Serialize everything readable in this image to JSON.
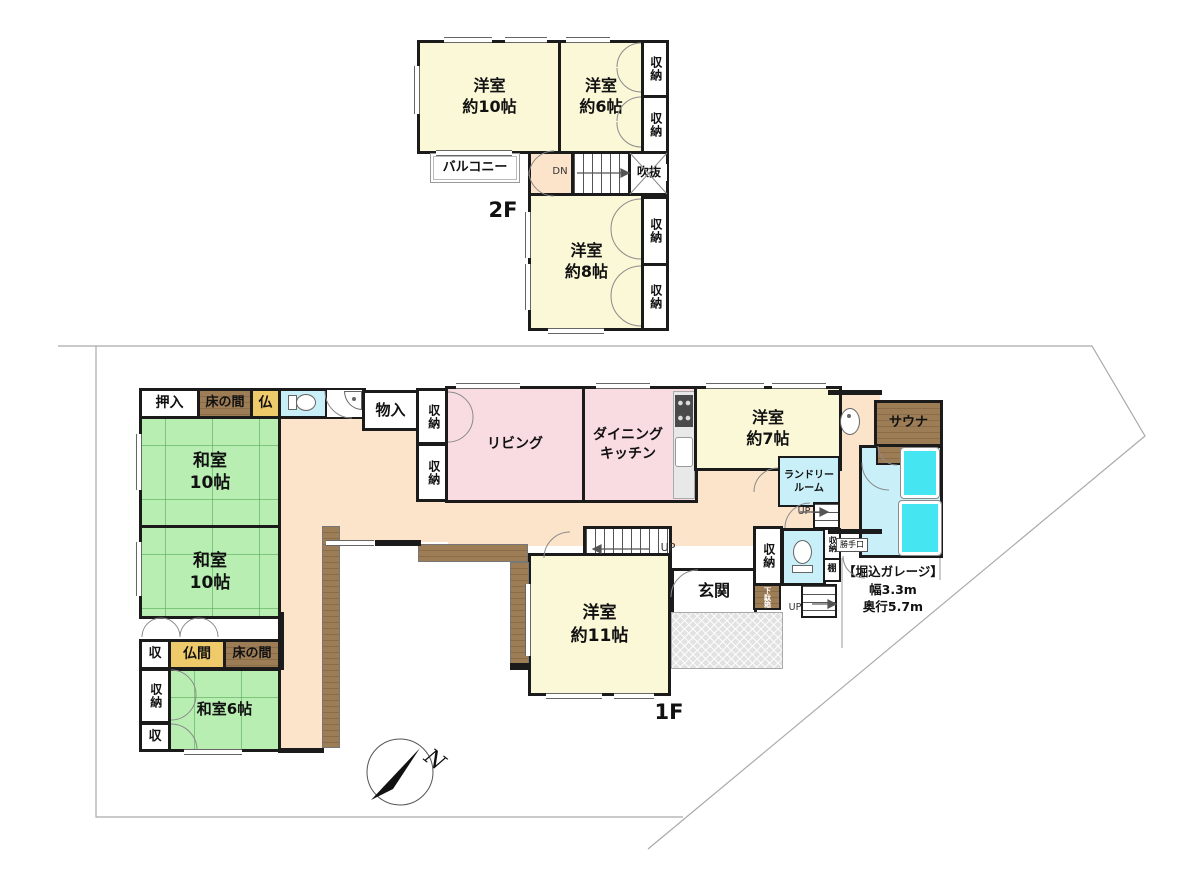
{
  "floor2": {
    "label": "2F",
    "rooms": {
      "western10": "洋室\n約10帖",
      "western6": "洋室\n約6帖",
      "western8": "洋室\n約8帖",
      "storage1": "収納",
      "storage2": "収納",
      "storage3": "収納",
      "storage4": "収納",
      "balcony": "バルコニー",
      "stairs_down": "DN",
      "void": "吹抜"
    }
  },
  "floor1": {
    "label": "1F",
    "rooms": {
      "oshiire": "押入",
      "tokonoma_top": "床の間",
      "butsu": "仏",
      "monoire": "物入",
      "storage_a": "収納",
      "storage_b": "収納",
      "living": "リビング",
      "dining_kitchen": "ダイニング\nキッチン",
      "western7": "洋室\n約7帖",
      "laundry": "ランドリー\nルーム",
      "sauna": "サウナ",
      "japanese10_upper": "和室\n10帖",
      "japanese10_lower": "和室\n10帖",
      "shu_left": "収",
      "butsuma": "仏間",
      "tokonoma_bottom": "床の間",
      "storage_left": "収納",
      "shu_bottom": "収",
      "japanese6": "和室6帖",
      "western11": "洋室\n約11帖",
      "genkan": "玄関",
      "storage_genkan": "収納",
      "getabako": "下駄箱",
      "storage_small": "収納",
      "shelf": "棚",
      "katteguchi": "勝手口",
      "up_main": "UP",
      "up_side1": "UP",
      "up_side2": "UP"
    },
    "garage_note": "【堀込ガレージ】\n幅3.3m\n奥行5.7m"
  },
  "compass": {
    "north": "N"
  },
  "legend_colors": {
    "tatami_green": "#b9eeb3",
    "wood_brown": "#9c7d56",
    "western_room_cream": "#fbf8d8",
    "living_pink": "#f9dce1",
    "corridor_peach": "#fce4cb",
    "wet_area_blue": "#c9f0f8",
    "bathtub_cyan": "#45e6f2",
    "altar_yellow": "#eeca6b",
    "wall_black": "#1b1b1b",
    "site_boundary_gray": "#aaaaaa"
  }
}
